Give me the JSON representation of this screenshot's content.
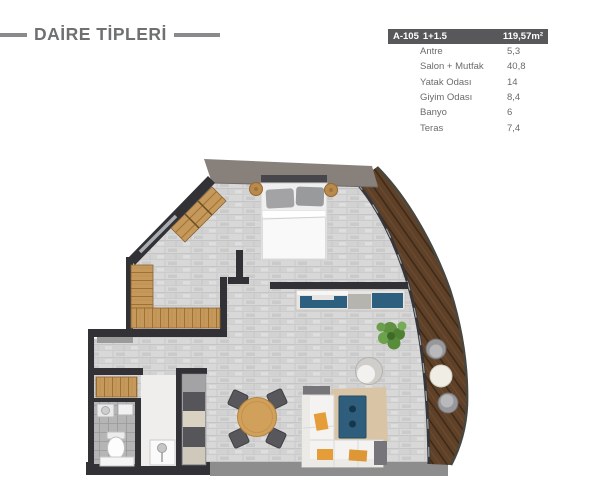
{
  "title": "DAİRE TİPLERİ",
  "unit_table": {
    "code": "A-105",
    "type": "1+1.5",
    "total_area": "119,57m²",
    "rows": [
      {
        "label": "Antre",
        "value": "5,3"
      },
      {
        "label": "Salon + Mutfak",
        "value": "40,8"
      },
      {
        "label": "Yatak Odası",
        "value": "14"
      },
      {
        "label": "Giyim Odası",
        "value": "8,4"
      },
      {
        "label": "Banyo",
        "value": "6"
      },
      {
        "label": "Teras",
        "value": "7,4"
      }
    ]
  },
  "colors": {
    "title_color": "#6f7072",
    "dash_color": "#8a8a8c",
    "table_header_bg": "#58585a",
    "table_header_text": "#ffffff",
    "table_row_text": "#6b6b6d",
    "wall_color": "#323236",
    "accent_blue": "#2d5f7e",
    "top_wall": "#87807b"
  }
}
